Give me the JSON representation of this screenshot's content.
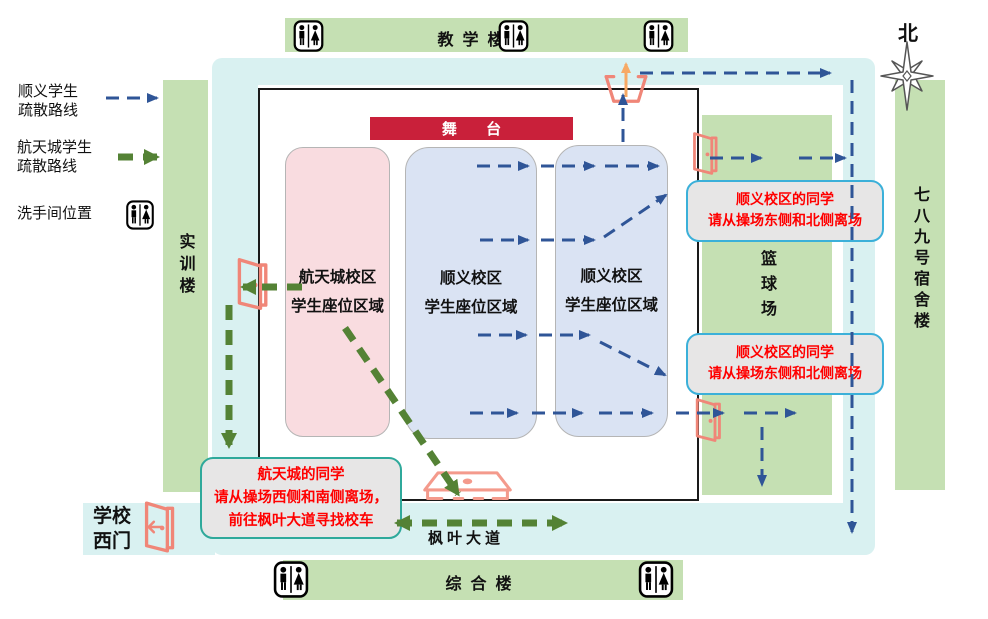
{
  "legend": {
    "shunyi_route": {
      "line1": "顺义学生",
      "line2": "疏散路线"
    },
    "hangtiancheng_route": {
      "line1": "航天城学生",
      "line2": "疏散路线"
    },
    "restroom": {
      "label": "洗手间位置"
    }
  },
  "compass": {
    "north_label": "北"
  },
  "buildings": {
    "teaching": "教学楼",
    "comprehensive": "综合楼",
    "training": "实训楼",
    "dormitory": "七八九号宿舍楼",
    "basketball_court": "篮球场"
  },
  "field": {
    "stage": "舞 台",
    "seats": [
      {
        "line1": "航天城校区",
        "line2": "学生座位区域"
      },
      {
        "line1": "顺义校区",
        "line2": "学生座位区域"
      },
      {
        "line1": "顺义校区",
        "line2": "学生座位区域"
      }
    ]
  },
  "notes": {
    "shunyi_north": {
      "line1": "顺义校区的同学",
      "line2": "请从操场东侧和北侧离场"
    },
    "shunyi_south": {
      "line1": "顺义校区的同学",
      "line2": "请从操场东侧和北侧离场"
    },
    "hangtiancheng": {
      "line1": "航天城的同学",
      "line2": "请从操场西侧和南侧离场，",
      "line3": "前往枫叶大道寻找校车"
    }
  },
  "labels": {
    "west_gate_line1": "学校",
    "west_gate_line2": "西门",
    "avenue": "枫叶大道"
  },
  "colors": {
    "building_green": "#c5e0b3",
    "track_blue": "#d9f1f1",
    "stage_red": "#c9203a",
    "hangtiancheng_area_pink": "#f9dce0",
    "shunyi_area_blue": "#dae3f3",
    "shunyi_route_blue": "#2f5597",
    "hangtiancheng_route_green": "#548235",
    "door_salmon": "#f08678",
    "note_fill_gray": "#e7e6e6",
    "note_border_blue": "#3bb0d9",
    "note_border_teal": "#2fa99b",
    "note_text_red": "#ff0000"
  }
}
